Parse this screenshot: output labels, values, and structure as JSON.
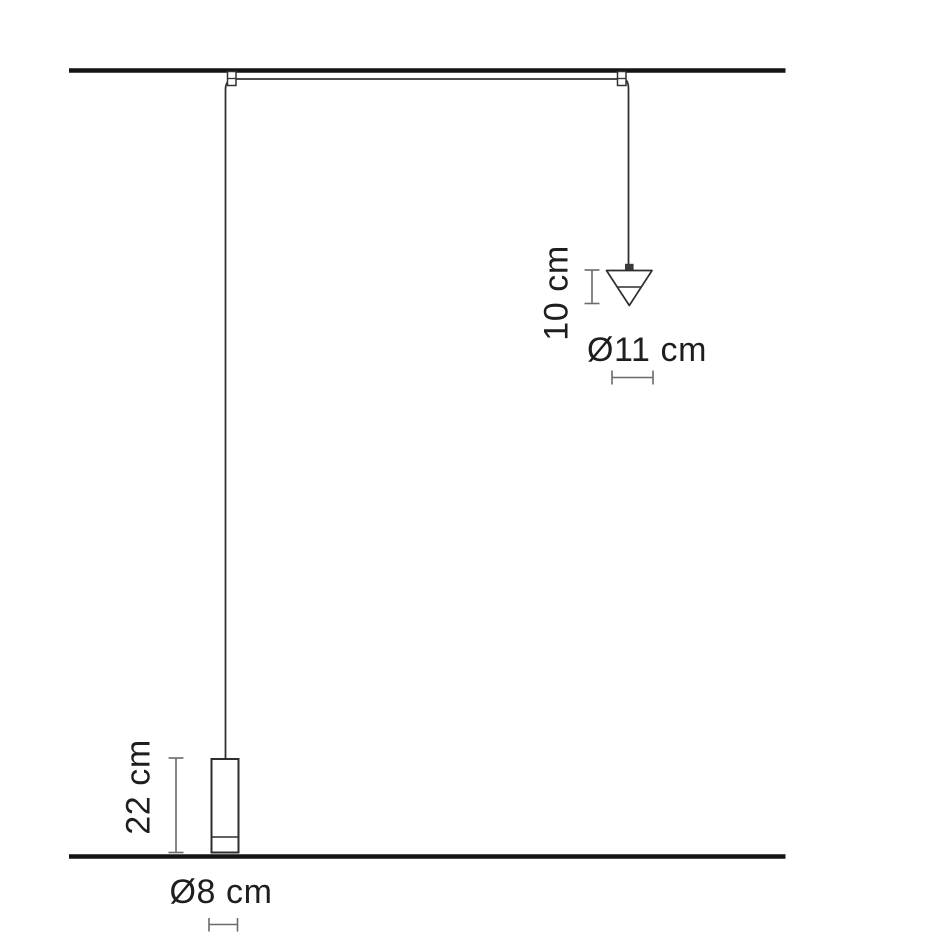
{
  "diagram": {
    "name": "Pendant lamps dimension drawing",
    "cone_lamp": {
      "height_label": "10 cm",
      "diameter_label": "Ø11 cm"
    },
    "cylinder_lamp": {
      "height_label": "22 cm",
      "diameter_label": "Ø8 cm"
    },
    "colors": {
      "structure_line": "#141414",
      "cable_outline": "#2e2e2e",
      "dimension_line": "#6a6a6a",
      "label_text": "#1e1e1e",
      "background": "#ffffff"
    }
  }
}
